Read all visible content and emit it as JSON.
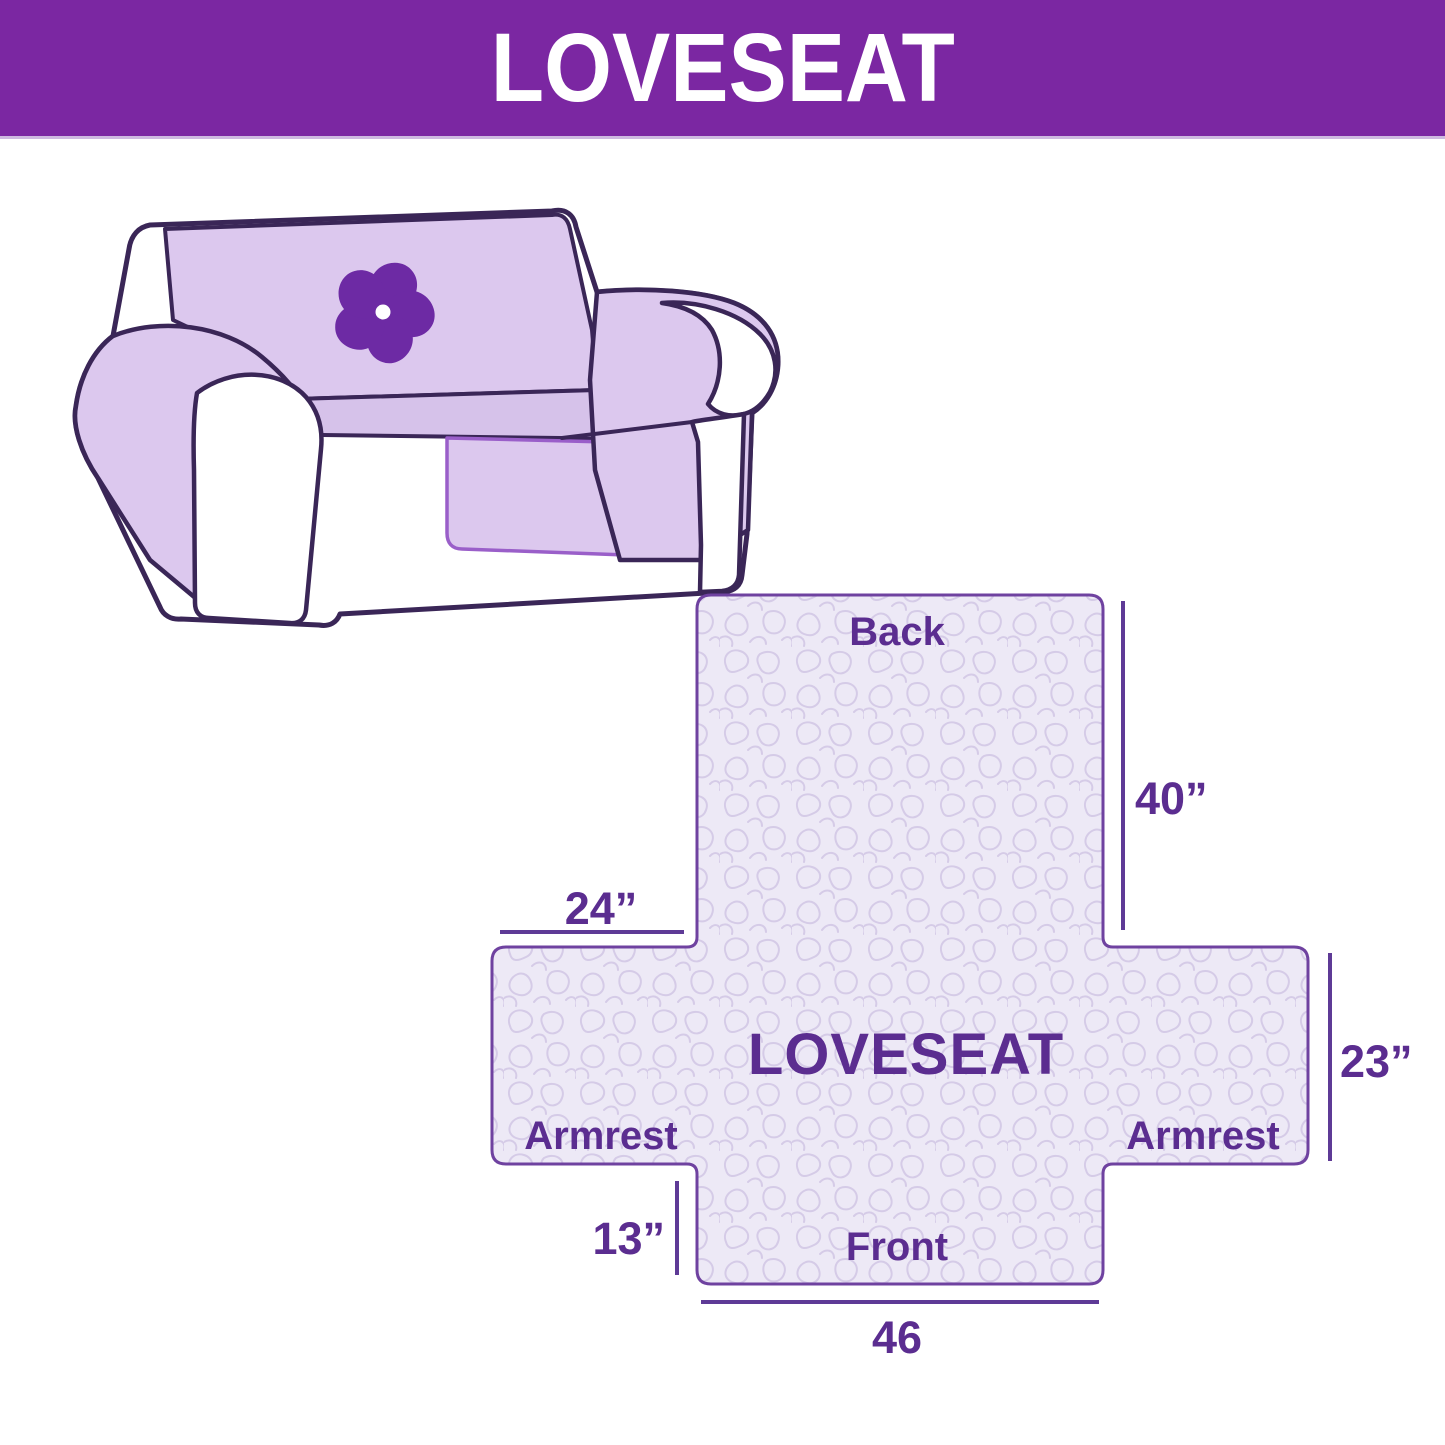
{
  "header": {
    "title": "LOVESEAT"
  },
  "illustration": {
    "alt": "loveseat-sofa-with-quilted-cover",
    "logo_icon": "pinwheel-flower-icon"
  },
  "diagram": {
    "center_label": "LOVESEAT",
    "back_label": "Back",
    "front_label": "Front",
    "armrest_left_label": "Armrest",
    "armrest_right_label": "Armrest",
    "dim_back_height": "40”",
    "dim_armrest_top_width": "24”",
    "dim_armrest_side_height": "23”",
    "dim_front_flap_height": "13”",
    "dim_front_width": "46"
  },
  "colors": {
    "header_bg": "#7b27a2",
    "header_text": "#ffffff",
    "label_text": "#5b2d90",
    "dim_line": "#5e3a96",
    "shape_outline": "#6f42a0",
    "shape_fill": "#ede9f6",
    "pattern_stroke": "#d5cbe7",
    "sofa_outline": "#3a2657",
    "cover_fill": "#dcc8ee",
    "seat_fill": "#d6c2ea",
    "skirt_edge": "#9a5fc9",
    "logo_purple": "#6d2aa4"
  }
}
